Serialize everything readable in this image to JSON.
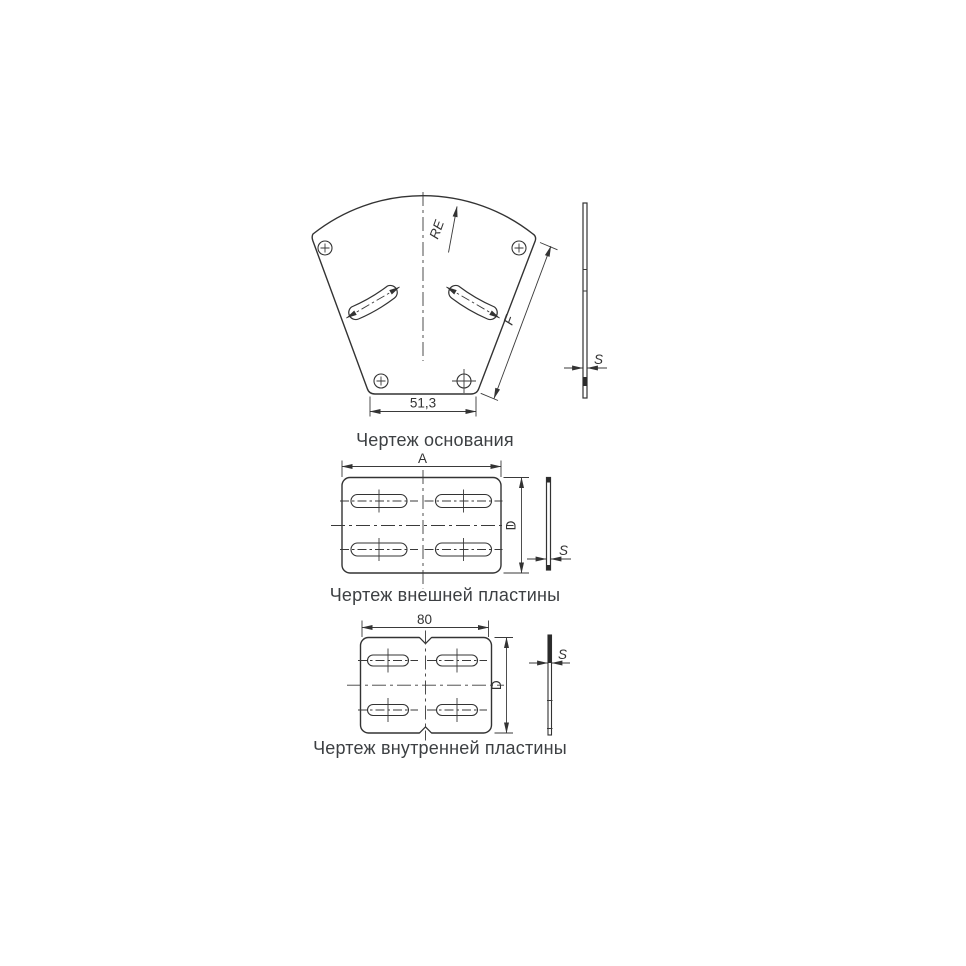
{
  "drawings": {
    "base": {
      "caption": "Чертеж основания",
      "dimensions": {
        "bottom_width": "51,3",
        "radius": "RE",
        "slant_length": "F",
        "thickness": "S"
      }
    },
    "outer_plate": {
      "caption": "Чертеж внешней пластины",
      "dimensions": {
        "width": "A",
        "height": "D",
        "thickness": "S"
      }
    },
    "inner_plate": {
      "caption": "Чертеж внутренней пластины",
      "dimensions": {
        "width": "80",
        "height": "D",
        "thickness": "S"
      }
    }
  },
  "colors": {
    "line": "#333333",
    "caption_text": "#3d4043",
    "background": "#ffffff"
  }
}
